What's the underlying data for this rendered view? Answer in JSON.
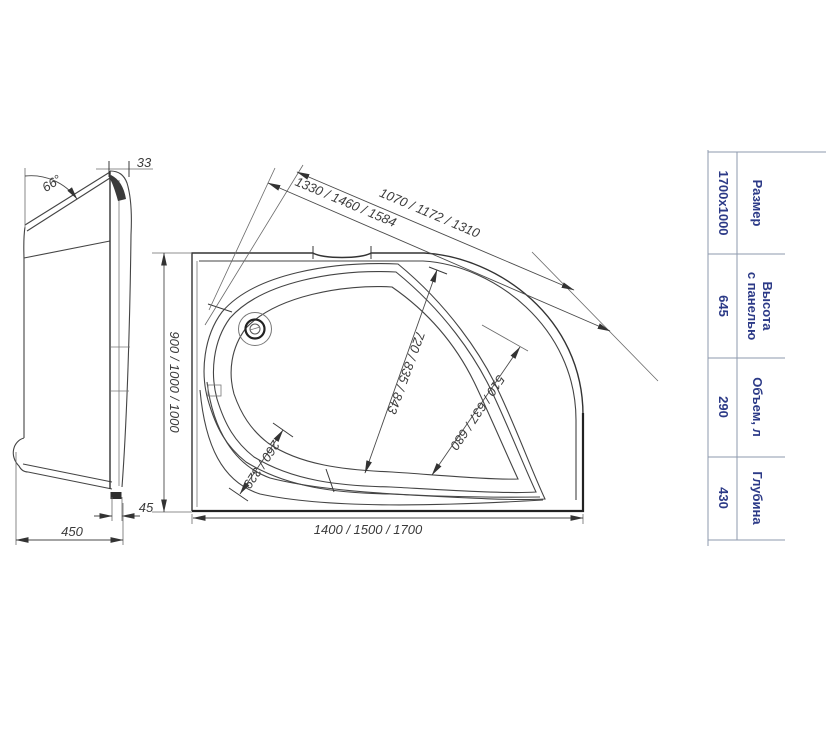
{
  "figure_title": "corner-bathtub-technical-drawing",
  "side_view": {
    "angle": "66°",
    "rim_width": "33",
    "foot_width": "45",
    "depth": "450"
  },
  "top_view": {
    "diag_outer": "1330 / 1460 / 1584",
    "diag_inner": "1070 / 1172 / 1310",
    "width": "900 / 1000 / 1000",
    "length": "1400 / 1500 / 1700",
    "basin_length": "720 / 835 / 843",
    "basin_width": "510 / 637 / 680",
    "seat": "260 / 329"
  },
  "spec_table": {
    "rows": [
      {
        "label": "Размер",
        "value": "1700x1000"
      },
      {
        "label_top": "Высота",
        "label_bottom": "с панелью",
        "value": "645"
      },
      {
        "label": "Объем, л",
        "value": "290"
      },
      {
        "label": "Глубина",
        "value": "430"
      }
    ]
  },
  "colors": {
    "drawing_line": "#444444",
    "heavy_line": "#222222",
    "dimension_text": "#3b3b3b",
    "table_text": "#2c3a87",
    "table_line": "#8d9aae",
    "background": "#ffffff"
  }
}
